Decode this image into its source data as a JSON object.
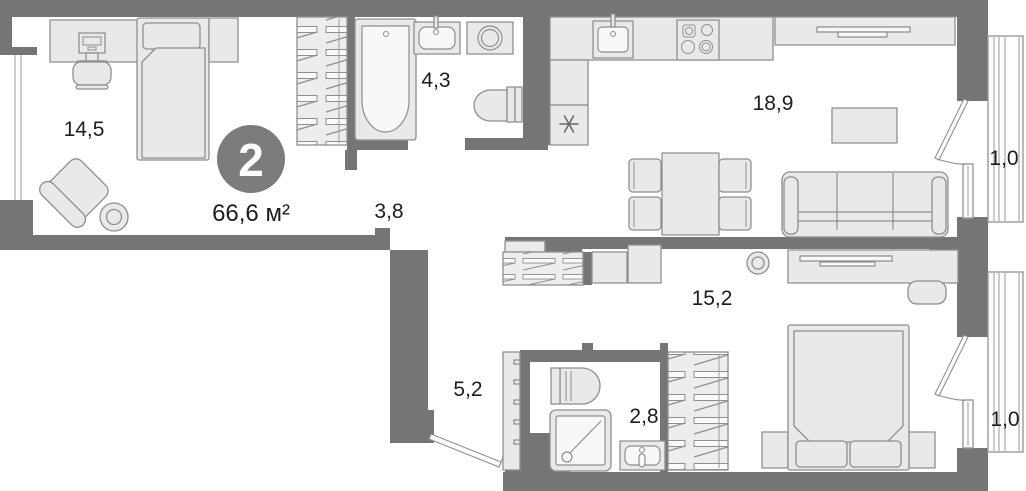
{
  "plan": {
    "badge": {
      "rooms_count": "2",
      "total_area": "66,6 м²"
    },
    "rooms": [
      {
        "name": "bedroom-1",
        "area": "14,5",
        "furniture": [
          "desk",
          "computer",
          "chair",
          "single-bed",
          "nightstand",
          "armchair",
          "side-table",
          "wardrobe"
        ]
      },
      {
        "name": "bathroom-1",
        "area": "4,3",
        "furniture": [
          "bathtub",
          "sink",
          "washing-machine",
          "toilet"
        ]
      },
      {
        "name": "corridor",
        "area": "3,8",
        "furniture": []
      },
      {
        "name": "kitchen-living",
        "area": "18,9",
        "furniture": [
          "kitchen-counter",
          "kitchen-sink",
          "stove",
          "refrigerator",
          "dining-table",
          "four-chairs",
          "tv-stand",
          "coffee-table",
          "sofa"
        ]
      },
      {
        "name": "loggia-top",
        "area": "1,0",
        "furniture": []
      },
      {
        "name": "bedroom-2",
        "area": "15,2",
        "furniture": [
          "wardrobe",
          "cabinets",
          "dresser-with-tv",
          "stool",
          "double-bed",
          "nightstands",
          "fan",
          "wardrobe-2"
        ]
      },
      {
        "name": "hallway",
        "area": "5,2",
        "furniture": [
          "shoe-cabinet",
          "entrance-door"
        ]
      },
      {
        "name": "shower-room",
        "area": "2,8",
        "furniture": [
          "toilet",
          "shower",
          "sink"
        ]
      },
      {
        "name": "loggia-bottom",
        "area": "1,0",
        "furniture": []
      }
    ],
    "colors": {
      "wall": "#757575",
      "furniture_fill": "#e9e9e9",
      "furniture_stroke": "#8f8f8f",
      "badge_fill": "#7c7c7c",
      "text": "#1d1d1d",
      "background": "#ffffff"
    }
  }
}
